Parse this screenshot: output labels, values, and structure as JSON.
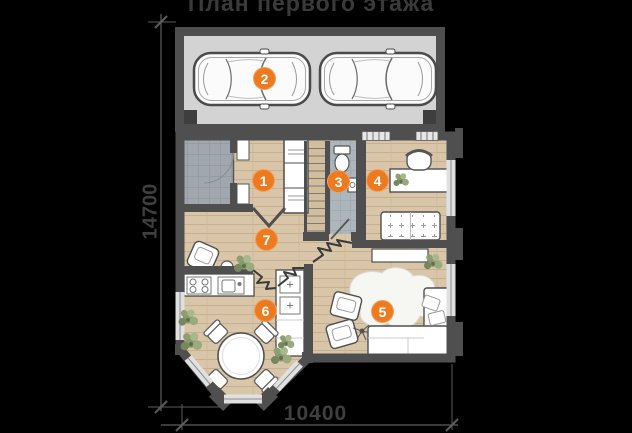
{
  "title": "План первого этажа",
  "dimensions": {
    "left": "14700",
    "bottom": "10400"
  },
  "rooms": [
    {
      "n": "1"
    },
    {
      "n": "2"
    },
    {
      "n": "3"
    },
    {
      "n": "4"
    },
    {
      "n": "5"
    },
    {
      "n": "6"
    },
    {
      "n": "7"
    }
  ],
  "colors": {
    "accent": "#ee7a1f",
    "background": "#000000",
    "wall": "#4f4f4f",
    "wood_floor": "#d9c6a9",
    "garage_floor": "#d3d3d3",
    "tile_floor": "#a3aab2"
  }
}
